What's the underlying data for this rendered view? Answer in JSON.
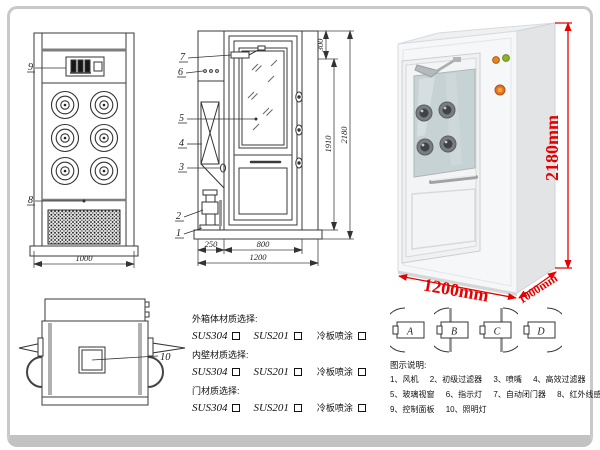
{
  "colors": {
    "dim_red": "#e60000",
    "line": "#333333",
    "gray_accent": "#7e7e7e"
  },
  "front_view": {
    "callout_9": "9",
    "callout_8": "8",
    "dim_width": "1000"
  },
  "side_view": {
    "callouts": [
      "7",
      "6",
      "5",
      "4",
      "3",
      "2",
      "1"
    ],
    "dim_300": "300",
    "dim_1910": "1910",
    "dim_2180": "2180",
    "dim_250": "250",
    "dim_800": "800",
    "dim_1200": "1200"
  },
  "top_view": {
    "callout_10": "10"
  },
  "photo": {
    "dim_height": "2180mm",
    "dim_width": "1200mm",
    "dim_depth": "1000mm"
  },
  "door_options": {
    "labels": [
      "A",
      "B",
      "C",
      "D"
    ]
  },
  "materials": {
    "sections": [
      {
        "title": "外箱体材质选择:",
        "opt1": "SUS304",
        "opt2": "SUS201",
        "opt3": "冷板喷涂"
      },
      {
        "title": "内壁材质选择:",
        "opt1": "SUS304",
        "opt2": "SUS201",
        "opt3": "冷板喷涂"
      },
      {
        "title": "门材质选择:",
        "opt1": "SUS304",
        "opt2": "SUS201",
        "opt3": "冷板喷涂"
      }
    ]
  },
  "legend": {
    "title": "图示说明:",
    "items": [
      "1、风机",
      "2、初级过滤器",
      "3、喷嘴",
      "4、高效过滤器",
      "5、玻璃视窗",
      "6、指示灯",
      "7、自动闭门器",
      "8、红外线感应器",
      "9、控制面板",
      "10、照明灯"
    ]
  }
}
